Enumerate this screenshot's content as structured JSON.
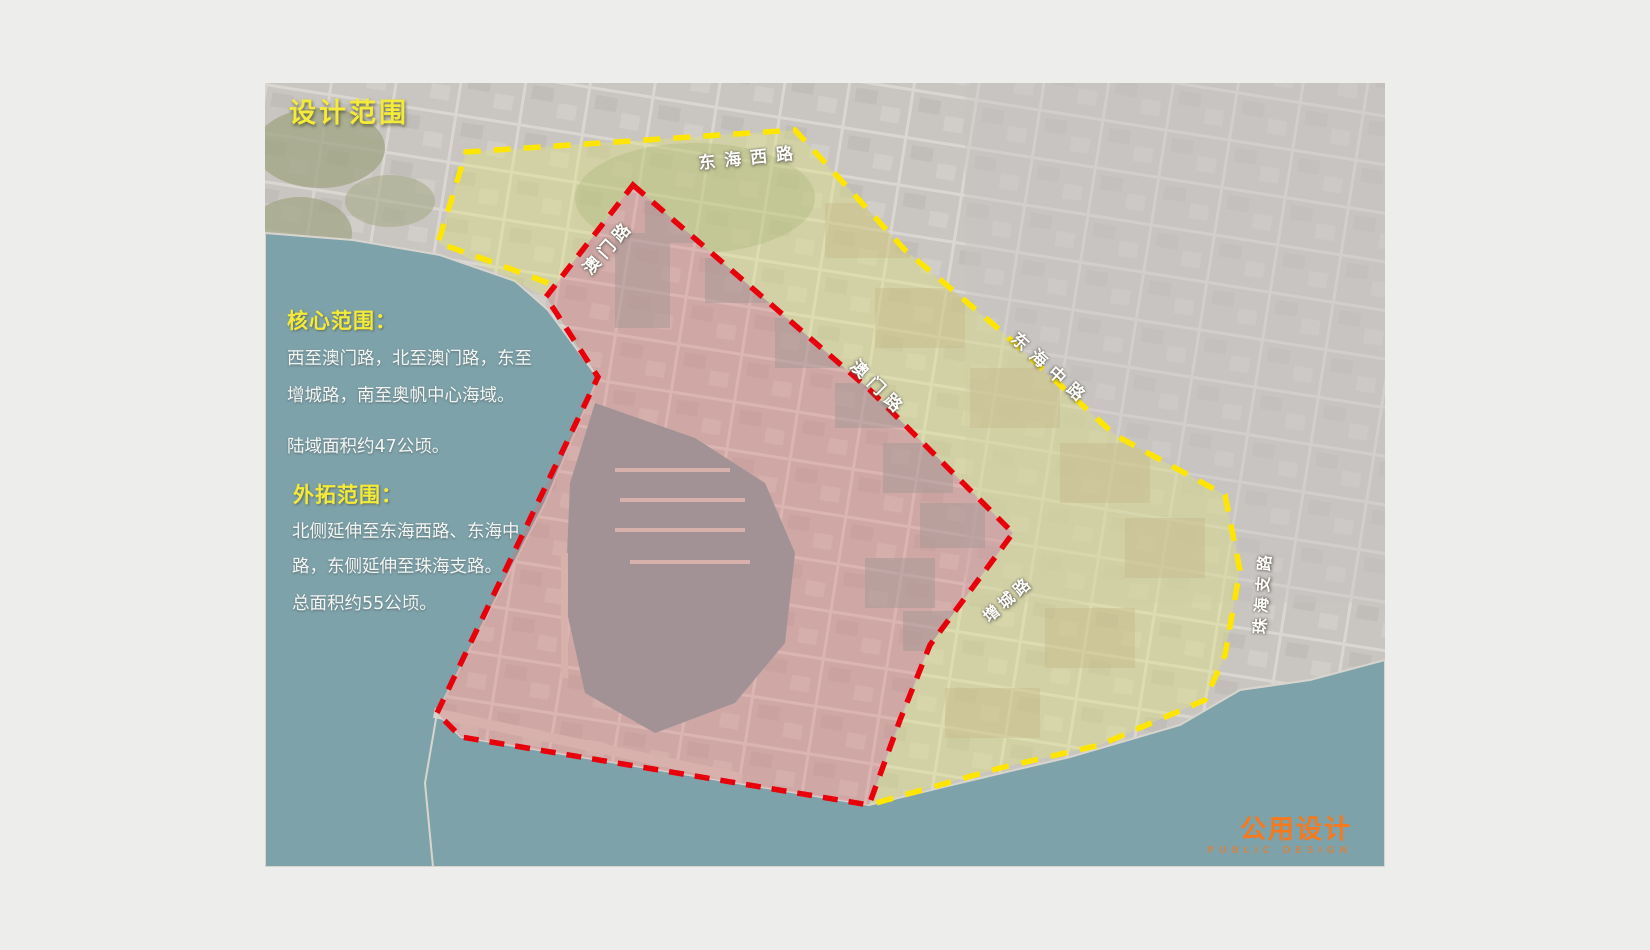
{
  "slide": {
    "title": "设计范围",
    "core": {
      "heading": "核心范围：",
      "body1": "西至澳门路，北至澳门路，东至增城路，南至奥帆中心海域。",
      "body2": "陆域面积约47公顷。"
    },
    "extended": {
      "heading": "外拓范围：",
      "body1": "北侧延伸至东海西路、东海中路，东侧延伸至珠海支路。",
      "body2": "总面积约55公顷。"
    },
    "logo": {
      "cn": "公用设计",
      "en": "PUBLIC DESIGN"
    }
  },
  "map": {
    "road_labels": [
      {
        "label": "东海西路"
      },
      {
        "label": "澳门路"
      },
      {
        "label": "澳门路"
      },
      {
        "label": "东海中路"
      },
      {
        "label": "增城路"
      },
      {
        "label": "珠海支路"
      }
    ],
    "areas": [
      {
        "name": "核心范围",
        "boundary_color": "#e8000b",
        "land_area": "约47公顷"
      },
      {
        "name": "外拓范围",
        "boundary_color": "#ffe600",
        "total_area": "约55公顷"
      }
    ]
  },
  "colors": {
    "title_yellow": "#f3ea39",
    "core_dash_red": "#e8000b",
    "extended_dash_yellow": "#ffe600",
    "logo_orange": "#f4791f",
    "sea_teal": "#7ea2aa",
    "page_gray": "#edeeec"
  }
}
